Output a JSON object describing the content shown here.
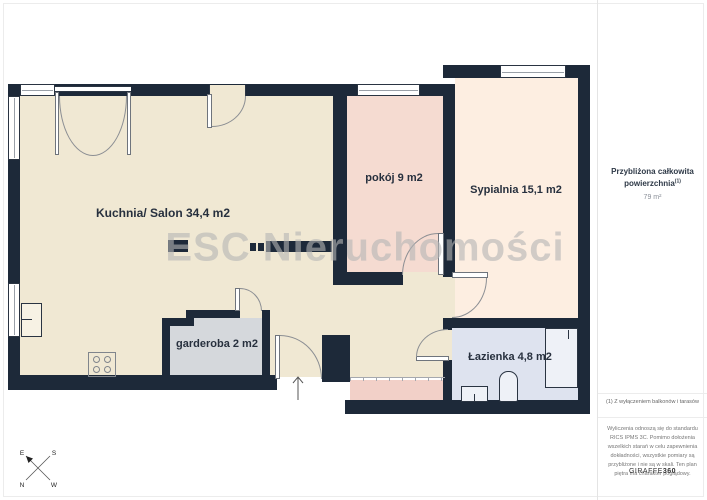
{
  "floorplan": {
    "watermark": "ESC Nieruchomości",
    "wall_color": "#1d2939",
    "rooms": [
      {
        "name": "kuchnia-salon",
        "label": "Kuchnia/ Salon 34,4 m2",
        "color": "#f0e8d3"
      },
      {
        "name": "pokoj",
        "label": "pokój 9 m2",
        "color": "#f5dbd1"
      },
      {
        "name": "sypialnia",
        "label": "Sypialnia 15,1 m2",
        "color": "#fdeee1"
      },
      {
        "name": "garderoba",
        "label": "garderoba 2 m2",
        "color": "#d5d8dc"
      },
      {
        "name": "lazienka",
        "label": "Łazienka 4,8 m2",
        "color": "#dee3ef"
      }
    ],
    "corridor_color": "#f2d0c8",
    "fixtures": [
      "kitchen-counter",
      "stove",
      "shower",
      "toilet",
      "sink"
    ],
    "compass": {
      "top_left": "E",
      "top_right": "S",
      "bottom_left": "N",
      "bottom_right": "W"
    }
  },
  "sidebar": {
    "total_area": {
      "label_line1": "Przybliżona całkowita",
      "label_line2": "powierzchnia",
      "superscript": "(1)",
      "value": "79 m²"
    },
    "footnote": "(1) Z wyłączeniem balkonów i tarasów",
    "disclaimer": "Wyliczenia odnoszą się do standardu RICS IPMS 3C. Pomimo dołożenia wszelkich starań w celu zapewnienia dokładności, wszystkie pomiary są przybliżone i nie są w skali. Ten plan piętra ma charakter poglądowy.",
    "brand": {
      "name": "GIRAFFE",
      "suffix": "360"
    }
  }
}
